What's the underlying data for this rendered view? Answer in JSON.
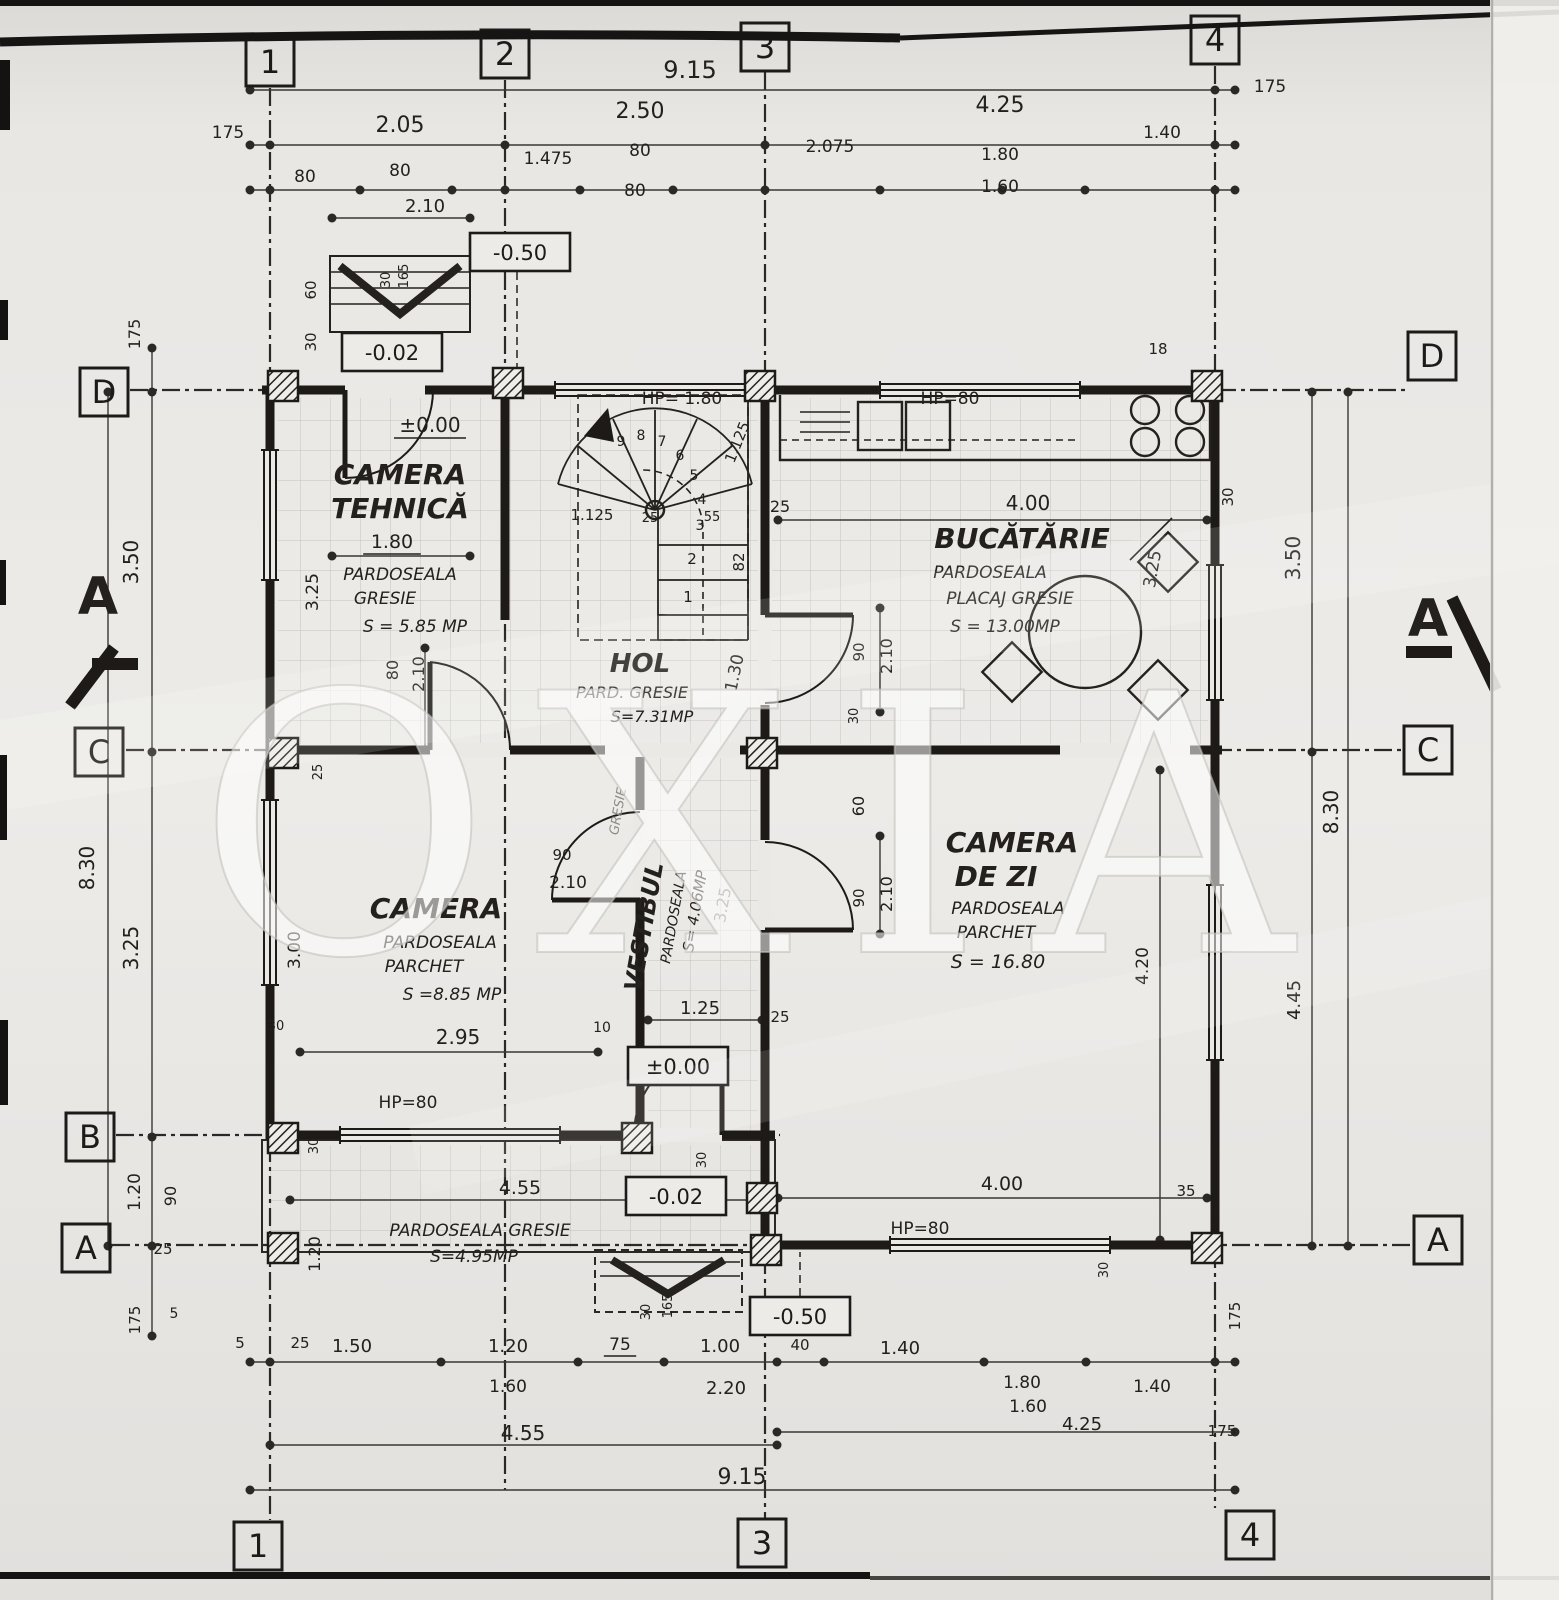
{
  "page": {
    "watermark": "OXIA"
  },
  "axis_markers": [
    {
      "n": "top-1",
      "t": "1",
      "x": 270,
      "y": 62
    },
    {
      "n": "top-2",
      "t": "2",
      "x": 505,
      "y": 54
    },
    {
      "n": "top-3",
      "t": "3",
      "x": 765,
      "y": 47
    },
    {
      "n": "top-4",
      "t": "4",
      "x": 1215,
      "y": 40
    },
    {
      "n": "bottom-1",
      "t": "1",
      "x": 258,
      "y": 1546
    },
    {
      "n": "bottom-3",
      "t": "3",
      "x": 762,
      "y": 1543
    },
    {
      "n": "bottom-4",
      "t": "4",
      "x": 1250,
      "y": 1535
    },
    {
      "n": "left-D",
      "t": "D",
      "x": 104,
      "y": 392
    },
    {
      "n": "left-C",
      "t": "C",
      "x": 99,
      "y": 752
    },
    {
      "n": "left-B",
      "t": "B",
      "x": 90,
      "y": 1137
    },
    {
      "n": "left-A",
      "t": "A",
      "x": 86,
      "y": 1248
    },
    {
      "n": "right-D",
      "t": "D",
      "x": 1432,
      "y": 356
    },
    {
      "n": "right-C",
      "t": "C",
      "x": 1428,
      "y": 750
    },
    {
      "n": "right-A",
      "t": "A",
      "x": 1438,
      "y": 1240
    }
  ],
  "level_markers": [
    {
      "n": "level-minus050-top",
      "t": "-0.50",
      "x": 520,
      "y": 252
    },
    {
      "n": "level-minus002-top",
      "t": "-0.02",
      "x": 392,
      "y": 352
    },
    {
      "n": "level-pm000-vestibul",
      "t": "±0.00",
      "x": 678,
      "y": 1066
    },
    {
      "n": "level-minus002-terrace",
      "t": "-0.02",
      "x": 676,
      "y": 1196
    },
    {
      "n": "level-minus050-bottom",
      "t": "-0.50",
      "x": 800,
      "y": 1316
    }
  ],
  "annotations": {
    "dimensions_top": [
      {
        "n": "dim-overall-top",
        "t": "9.15",
        "x": 690,
        "y": 78,
        "s": 24
      },
      {
        "n": "dim-1-2",
        "t": "2.05",
        "x": 400,
        "y": 132,
        "s": 22
      },
      {
        "n": "dim-2-3",
        "t": "2.50",
        "x": 640,
        "y": 118,
        "s": 22
      },
      {
        "n": "dim-3-4",
        "t": "4.25",
        "x": 1000,
        "y": 112,
        "s": 22
      },
      {
        "n": "dim-margin-left-top",
        "t": "175",
        "x": 228,
        "y": 138,
        "s": 17
      },
      {
        "n": "dim-margin-right-top",
        "t": "175",
        "x": 1270,
        "y": 92,
        "s": 17
      },
      {
        "n": "dim-top-80-a",
        "t": "80",
        "x": 305,
        "y": 182,
        "s": 17
      },
      {
        "n": "dim-top-80-b",
        "t": "80",
        "x": 400,
        "y": 176,
        "s": 17
      },
      {
        "n": "dim-top-210",
        "t": "2.10",
        "x": 425,
        "y": 212,
        "s": 18
      },
      {
        "n": "dim-top-1475",
        "t": "1.475",
        "x": 548,
        "y": 164,
        "s": 17
      },
      {
        "n": "dim-top-80-c",
        "t": "80",
        "x": 640,
        "y": 156,
        "s": 17
      },
      {
        "n": "dim-top-80-d",
        "t": "80",
        "x": 635,
        "y": 196,
        "s": 17
      },
      {
        "n": "dim-top-2075",
        "t": "2.075",
        "x": 830,
        "y": 152,
        "s": 17
      },
      {
        "n": "dim-top-180",
        "t": "1.80",
        "x": 1000,
        "y": 160,
        "s": 17
      },
      {
        "n": "dim-top-160",
        "t": "1.60",
        "x": 1000,
        "y": 192,
        "s": 17
      },
      {
        "n": "dim-top-140",
        "t": "1.40",
        "x": 1162,
        "y": 138,
        "s": 17
      }
    ],
    "dimensions_left": [
      {
        "n": "dim-left-175-top",
        "t": "175",
        "x": 140,
        "y": 334,
        "s": 16,
        "r": -90
      },
      {
        "n": "dim-left-350",
        "t": "3.50",
        "x": 138,
        "y": 562,
        "s": 20,
        "r": -90
      },
      {
        "n": "dim-left-830",
        "t": "8.30",
        "x": 94,
        "y": 868,
        "s": 20,
        "r": -90
      },
      {
        "n": "dim-left-325",
        "t": "3.25",
        "x": 138,
        "y": 948,
        "s": 20,
        "r": -90
      },
      {
        "n": "dim-left-120",
        "t": "1.20",
        "x": 140,
        "y": 1192,
        "s": 17,
        "r": -90
      },
      {
        "n": "dim-left-90",
        "t": "90",
        "x": 176,
        "y": 1196,
        "s": 16,
        "r": -90
      },
      {
        "n": "dim-left-25",
        "t": "25",
        "x": 163,
        "y": 1254,
        "s": 15
      },
      {
        "n": "dim-left-175-bottom",
        "t": "175",
        "x": 140,
        "y": 1320,
        "s": 15,
        "r": -90
      },
      {
        "n": "dim-left-5a",
        "t": "5",
        "x": 174,
        "y": 1318,
        "s": 14
      },
      {
        "n": "dim-left-5b",
        "t": "5",
        "x": 240,
        "y": 1348,
        "s": 15
      },
      {
        "n": "dim-left-25b",
        "t": "25",
        "x": 300,
        "y": 1348,
        "s": 15
      }
    ],
    "dimensions_right": [
      {
        "n": "dim-right-350",
        "t": "3.50",
        "x": 1300,
        "y": 558,
        "s": 20,
        "r": -90
      },
      {
        "n": "dim-right-830",
        "t": "8.30",
        "x": 1338,
        "y": 812,
        "s": 20,
        "r": -90
      },
      {
        "n": "dim-right-445",
        "t": "4.45",
        "x": 1300,
        "y": 1000,
        "s": 18,
        "r": -90
      },
      {
        "n": "dim-right-420",
        "t": "4.20",
        "x": 1148,
        "y": 966,
        "s": 17,
        "r": -90
      },
      {
        "n": "dim-right-30",
        "t": "30",
        "x": 1233,
        "y": 497,
        "s": 15,
        "r": -90
      },
      {
        "n": "dim-right-175-bottom",
        "t": "175",
        "x": 1240,
        "y": 1316,
        "s": 15,
        "r": -90
      },
      {
        "n": "dim-right-175-low",
        "t": "175",
        "x": 1222,
        "y": 1436,
        "s": 15
      }
    ],
    "dimensions_bottom": [
      {
        "n": "dim-bot-150",
        "t": "1.50",
        "x": 352,
        "y": 1352,
        "s": 18
      },
      {
        "n": "dim-bot-120",
        "t": "1.20",
        "x": 508,
        "y": 1352,
        "s": 18
      },
      {
        "n": "dim-bot-75",
        "t": "75",
        "x": 620,
        "y": 1350,
        "s": 17,
        "u": 1
      },
      {
        "n": "dim-bot-100",
        "t": "1.00",
        "x": 720,
        "y": 1352,
        "s": 18
      },
      {
        "n": "dim-bot-40",
        "t": "40",
        "x": 800,
        "y": 1350,
        "s": 15
      },
      {
        "n": "dim-bot-140a",
        "t": "1.40",
        "x": 900,
        "y": 1354,
        "s": 18
      },
      {
        "n": "dim-bot-160a",
        "t": "1.60",
        "x": 508,
        "y": 1392,
        "s": 17
      },
      {
        "n": "dim-bot-220",
        "t": "2.20",
        "x": 726,
        "y": 1394,
        "s": 18
      },
      {
        "n": "dim-bot-455",
        "t": "4.55",
        "x": 523,
        "y": 1440,
        "s": 20
      },
      {
        "n": "dim-bot-915",
        "t": "9.15",
        "x": 742,
        "y": 1484,
        "s": 22
      },
      {
        "n": "dim-bot-180",
        "t": "1.80",
        "x": 1022,
        "y": 1388,
        "s": 17
      },
      {
        "n": "dim-bot-160b",
        "t": "1.60",
        "x": 1028,
        "y": 1412,
        "s": 17
      },
      {
        "n": "dim-bot-140b",
        "t": "1.40",
        "x": 1152,
        "y": 1392,
        "s": 17
      },
      {
        "n": "dim-bot-425",
        "t": "4.25",
        "x": 1082,
        "y": 1430,
        "s": 18
      }
    ],
    "room_camera_tehnica": [
      {
        "n": "room-camera-tehnica-title-1",
        "t": "CAMERA",
        "x": 400,
        "y": 484,
        "s": 28,
        "b": 1,
        "i": 1
      },
      {
        "n": "room-camera-tehnica-title-2",
        "t": "TEHNICĂ",
        "x": 400,
        "y": 518,
        "s": 28,
        "b": 1,
        "i": 1
      },
      {
        "n": "room-camera-tehnica-dim",
        "t": "1.80",
        "x": 392,
        "y": 548,
        "s": 19,
        "u": 1
      },
      {
        "n": "room-camera-tehnica-floor-1",
        "t": "PARDOSEALA",
        "x": 400,
        "y": 580,
        "s": 17,
        "i": 1
      },
      {
        "n": "room-camera-tehnica-floor-2",
        "t": "GRESIE",
        "x": 385,
        "y": 604,
        "s": 17,
        "i": 1
      },
      {
        "n": "room-camera-tehnica-area",
        "t": "S = 5.85 MP",
        "x": 415,
        "y": 632,
        "s": 17,
        "i": 1
      },
      {
        "n": "dim-ct-325",
        "t": "3.25",
        "x": 318,
        "y": 592,
        "s": 17,
        "r": -90
      },
      {
        "n": "dim-ct-80",
        "t": "80",
        "x": 398,
        "y": 670,
        "s": 16,
        "r": -90
      },
      {
        "n": "dim-ct-210",
        "t": "2.10",
        "x": 424,
        "y": 674,
        "s": 16,
        "r": -90
      },
      {
        "n": "level-pm000-ct",
        "t": "±0.00",
        "x": 430,
        "y": 432,
        "s": 20,
        "u": 1
      },
      {
        "n": "dim-c-25",
        "t": "25",
        "x": 322,
        "y": 772,
        "s": 13,
        "r": -90
      }
    ],
    "room_hol": [
      {
        "n": "room-hol-title",
        "t": "HOL",
        "x": 640,
        "y": 672,
        "s": 26,
        "b": 1,
        "i": 1
      },
      {
        "n": "room-hol-floor",
        "t": "PARD. GRESIE",
        "x": 632,
        "y": 698,
        "s": 16,
        "i": 1
      },
      {
        "n": "room-hol-area",
        "t": "S=7.31MP",
        "x": 652,
        "y": 722,
        "s": 16,
        "i": 1
      },
      {
        "n": "dim-hol-130",
        "t": "1.30",
        "x": 740,
        "y": 674,
        "s": 17,
        "r": -78
      }
    ],
    "stair": [
      {
        "n": "stair-hp",
        "t": "HP= 1.80",
        "x": 682,
        "y": 404,
        "s": 17
      },
      {
        "n": "stair-1125-diag",
        "t": "1.125",
        "x": 742,
        "y": 444,
        "s": 15,
        "r": -68
      },
      {
        "n": "stair-1125-h",
        "t": "1.125",
        "x": 592,
        "y": 520,
        "s": 15
      },
      {
        "n": "stair-25a",
        "t": "25",
        "x": 650,
        "y": 522,
        "s": 13
      },
      {
        "n": "stair-55",
        "t": "55",
        "x": 712,
        "y": 521,
        "s": 13
      },
      {
        "n": "stair-25-wall",
        "t": "25",
        "x": 780,
        "y": 512,
        "s": 16
      },
      {
        "n": "stair-82",
        "t": "82",
        "x": 744,
        "y": 562,
        "s": 15,
        "r": -90
      },
      {
        "n": "stair-step-1",
        "t": "1",
        "x": 688,
        "y": 602,
        "s": 15
      },
      {
        "n": "stair-step-2",
        "t": "2",
        "x": 692,
        "y": 564,
        "s": 15
      },
      {
        "n": "stair-step-3",
        "t": "3",
        "x": 700,
        "y": 530,
        "s": 14
      },
      {
        "n": "stair-step-4",
        "t": "4",
        "x": 702,
        "y": 504,
        "s": 14
      },
      {
        "n": "stair-step-5",
        "t": "5",
        "x": 694,
        "y": 480,
        "s": 14
      },
      {
        "n": "stair-step-6",
        "t": "6",
        "x": 680,
        "y": 460,
        "s": 14
      },
      {
        "n": "stair-step-7",
        "t": "7",
        "x": 662,
        "y": 446,
        "s": 14
      },
      {
        "n": "stair-step-8",
        "t": "8",
        "x": 641,
        "y": 440,
        "s": 14
      },
      {
        "n": "stair-step-9",
        "t": "9",
        "x": 621,
        "y": 446,
        "s": 14
      }
    ],
    "room_bucatarie": [
      {
        "n": "dim-kitchen-400",
        "t": "4.00",
        "x": 1028,
        "y": 510,
        "s": 20
      },
      {
        "n": "room-bucatarie-title",
        "t": "BUCĂTĂRIE",
        "x": 1022,
        "y": 548,
        "s": 28,
        "b": 1,
        "i": 1
      },
      {
        "n": "room-bucatarie-floor-1",
        "t": "PARDOSEALA",
        "x": 990,
        "y": 578,
        "s": 17,
        "i": 1
      },
      {
        "n": "room-bucatarie-floor-2",
        "t": "PLACAJ GRESIE",
        "x": 1010,
        "y": 604,
        "s": 17,
        "i": 1
      },
      {
        "n": "room-bucatarie-area",
        "t": "S = 13.00MP",
        "x": 1005,
        "y": 632,
        "s": 17,
        "i": 1
      },
      {
        "n": "dim-kitchen-325",
        "t": "3.25",
        "x": 1158,
        "y": 570,
        "s": 17,
        "r": -80
      },
      {
        "n": "dim-kitchen-hp80",
        "t": "HP=80",
        "x": 950,
        "y": 404,
        "s": 17
      },
      {
        "n": "dim-kitchen-18",
        "t": "18",
        "x": 1158,
        "y": 354,
        "s": 15
      },
      {
        "n": "door-bucatarie-90",
        "t": "90",
        "x": 864,
        "y": 652,
        "s": 15,
        "r": -90
      },
      {
        "n": "door-bucatarie-210",
        "t": "2.10",
        "x": 892,
        "y": 656,
        "s": 16,
        "r": -90
      },
      {
        "n": "dim-kitchen-30",
        "t": "30",
        "x": 858,
        "y": 716,
        "s": 13,
        "r": -90
      }
    ],
    "room_camera": [
      {
        "n": "room-camera-title",
        "t": "CAMERA",
        "x": 436,
        "y": 918,
        "s": 28,
        "b": 1,
        "i": 1
      },
      {
        "n": "room-camera-floor-1",
        "t": "PARDOSEALA",
        "x": 440,
        "y": 948,
        "s": 17,
        "i": 1
      },
      {
        "n": "room-camera-floor-2",
        "t": "PARCHET",
        "x": 424,
        "y": 972,
        "s": 17,
        "i": 1
      },
      {
        "n": "room-camera-area",
        "t": "S =8.85 MP",
        "x": 452,
        "y": 1000,
        "s": 17,
        "i": 1
      },
      {
        "n": "dim-camera-295",
        "t": "2.95",
        "x": 458,
        "y": 1044,
        "s": 20
      },
      {
        "n": "dim-camera-300",
        "t": "3.00",
        "x": 300,
        "y": 950,
        "s": 17,
        "r": -90
      },
      {
        "n": "dim-camera-10",
        "t": "10",
        "x": 602,
        "y": 1032,
        "s": 14
      },
      {
        "n": "dim-camera-hp80",
        "t": "HP=80",
        "x": 408,
        "y": 1108,
        "s": 17
      },
      {
        "n": "door-camera-90",
        "t": "90",
        "x": 562,
        "y": 860,
        "s": 15
      },
      {
        "n": "door-camera-210",
        "t": "2.10",
        "x": 568,
        "y": 888,
        "s": 17
      },
      {
        "n": "dim-camera-30a",
        "t": "30",
        "x": 276,
        "y": 1030,
        "s": 13
      },
      {
        "n": "dim-camera-30b",
        "t": "30",
        "x": 318,
        "y": 1146,
        "s": 13,
        "r": -90
      }
    ],
    "room_vestibul": [
      {
        "n": "room-vestibul-title",
        "t": "VESTIBUL",
        "x": 652,
        "y": 928,
        "s": 24,
        "b": 1,
        "i": 1,
        "r": -80
      },
      {
        "n": "room-vestibul-floor-1",
        "t": "PARDOSEALA",
        "x": 678,
        "y": 918,
        "s": 14,
        "i": 1,
        "r": -80
      },
      {
        "n": "room-vestibul-floor-2",
        "t": "GRESIE",
        "x": 622,
        "y": 812,
        "s": 13,
        "i": 1,
        "r": -80,
        "m": 1
      },
      {
        "n": "room-vestibul-area",
        "t": "S= 4.06MP",
        "x": 700,
        "y": 912,
        "s": 15,
        "i": 1,
        "r": -80
      },
      {
        "n": "dim-vestibul-325",
        "t": "3.25",
        "x": 728,
        "y": 906,
        "s": 16,
        "r": -80,
        "m": 1
      },
      {
        "n": "dim-vestibul-125",
        "t": "1.25",
        "x": 700,
        "y": 1014,
        "s": 18
      },
      {
        "n": "dim-vestibul-25",
        "t": "25",
        "x": 780,
        "y": 1022,
        "s": 15
      },
      {
        "n": "door-entry-30",
        "t": "30",
        "x": 706,
        "y": 1160,
        "s": 13,
        "r": -90
      }
    ],
    "room_camera_de_zi": [
      {
        "n": "room-cdz-title-1",
        "t": "CAMERA",
        "x": 1012,
        "y": 852,
        "s": 28,
        "b": 1,
        "i": 1
      },
      {
        "n": "room-cdz-title-2",
        "t": "DE ZI",
        "x": 996,
        "y": 886,
        "s": 28,
        "b": 1,
        "i": 1
      },
      {
        "n": "room-cdz-floor-1",
        "t": "PARDOSEALA",
        "x": 1008,
        "y": 914,
        "s": 17,
        "i": 1
      },
      {
        "n": "room-cdz-floor-2",
        "t": "PARCHET",
        "x": 996,
        "y": 938,
        "s": 17,
        "i": 1
      },
      {
        "n": "room-cdz-area",
        "t": "S = 16.80",
        "x": 998,
        "y": 968,
        "s": 19,
        "i": 1
      },
      {
        "n": "door-cdz-90",
        "t": "90",
        "x": 864,
        "y": 898,
        "s": 15,
        "r": -90
      },
      {
        "n": "door-cdz-210",
        "t": "2.10",
        "x": 892,
        "y": 894,
        "s": 16,
        "r": -90
      },
      {
        "n": "dim-cdz-60",
        "t": "60",
        "x": 864,
        "y": 806,
        "s": 16,
        "r": -90
      },
      {
        "n": "dim-cdz-35",
        "t": "35",
        "x": 1186,
        "y": 1196,
        "s": 15
      },
      {
        "n": "dim-cdz-30",
        "t": "30",
        "x": 1108,
        "y": 1270,
        "s": 13,
        "r": -90
      }
    ],
    "terrace": [
      {
        "n": "dim-terrace-455",
        "t": "4.55",
        "x": 520,
        "y": 1194,
        "s": 19
      },
      {
        "n": "room-terrace-floor",
        "t": "PARDOSEALA GRESIE",
        "x": 480,
        "y": 1236,
        "s": 17,
        "i": 1
      },
      {
        "n": "room-terrace-area",
        "t": "S=4.95MP",
        "x": 474,
        "y": 1262,
        "s": 17,
        "i": 1
      },
      {
        "n": "dim-terrace-120",
        "t": "1.20",
        "x": 320,
        "y": 1254,
        "s": 16,
        "r": -90
      },
      {
        "n": "dim-bot-400",
        "t": "4.00",
        "x": 1002,
        "y": 1190,
        "s": 19
      },
      {
        "n": "dim-bot-hp80",
        "t": "HP=80",
        "x": 920,
        "y": 1234,
        "s": 17
      },
      {
        "n": "steps-30",
        "t": "30",
        "x": 650,
        "y": 1312,
        "s": 13,
        "r": -90
      },
      {
        "n": "steps-165",
        "t": "165",
        "x": 672,
        "y": 1306,
        "s": 13,
        "r": -90
      }
    ],
    "porch": [
      {
        "n": "porch-30",
        "t": "30",
        "x": 390,
        "y": 280,
        "s": 13,
        "r": -90
      },
      {
        "n": "porch-165",
        "t": "165",
        "x": 408,
        "y": 276,
        "s": 13,
        "r": -90
      },
      {
        "n": "porch-60",
        "t": "60",
        "x": 316,
        "y": 290,
        "s": 15,
        "r": -90
      },
      {
        "n": "porch-30b",
        "t": "30",
        "x": 316,
        "y": 342,
        "s": 15,
        "r": -90
      }
    ],
    "section": [
      {
        "n": "section-a-left",
        "t": "A",
        "x": 98,
        "y": 614,
        "s": 52,
        "b": 1
      },
      {
        "n": "section-a-right",
        "t": "A",
        "x": 1428,
        "y": 636,
        "s": 52,
        "b": 1
      }
    ]
  }
}
